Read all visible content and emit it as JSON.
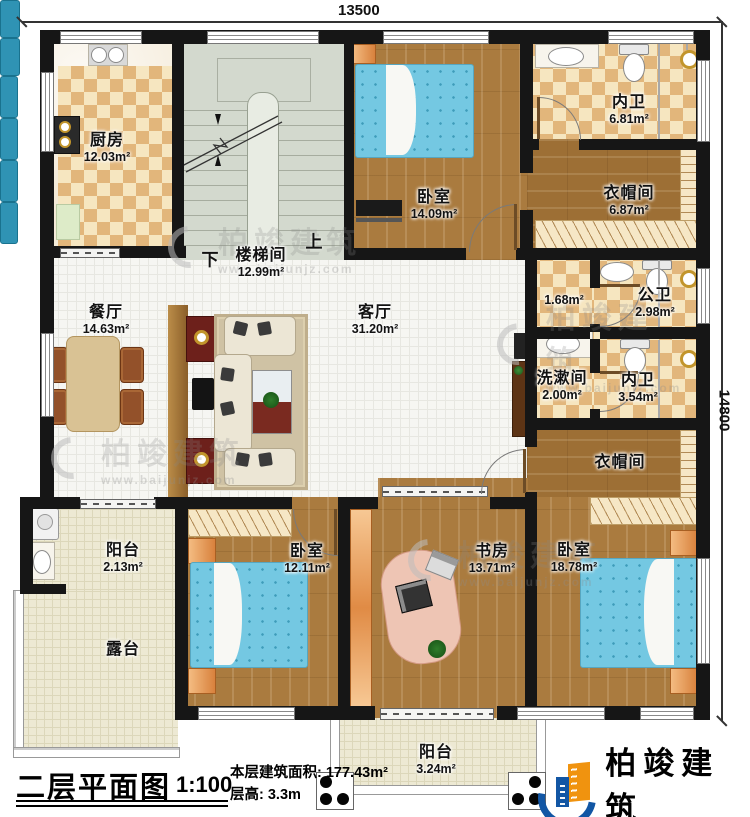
{
  "dimensions": {
    "top": "13500",
    "right": "14800"
  },
  "stair": {
    "down": "下",
    "up": "上"
  },
  "rooms": [
    {
      "key": "kitchen",
      "name": "厨房",
      "area": "12.03m²"
    },
    {
      "key": "stairwell",
      "name": "楼梯间",
      "area": "12.99m²"
    },
    {
      "key": "bedroom-top",
      "name": "卧室",
      "area": "14.09m²"
    },
    {
      "key": "ensuite-top",
      "name": "内卫",
      "area": "6.81m²"
    },
    {
      "key": "closet-top",
      "name": "衣帽间",
      "area": "6.87m²"
    },
    {
      "key": "hallway",
      "name": "",
      "area": "1.68m²"
    },
    {
      "key": "public-bath",
      "name": "公卫",
      "area": "2.98m²"
    },
    {
      "key": "washroom",
      "name": "洗漱间",
      "area": "2.00m²"
    },
    {
      "key": "ensuite-mid",
      "name": "内卫",
      "area": "3.54m²"
    },
    {
      "key": "closet-mid",
      "name": "衣帽间",
      "area": ""
    },
    {
      "key": "dining",
      "name": "餐厅",
      "area": "14.63m²"
    },
    {
      "key": "living",
      "name": "客厅",
      "area": "31.20m²"
    },
    {
      "key": "balcony-left",
      "name": "阳台",
      "area": "2.13m²"
    },
    {
      "key": "terrace",
      "name": "露台",
      "area": ""
    },
    {
      "key": "bedroom-left",
      "name": "卧室",
      "area": "12.11m²"
    },
    {
      "key": "study",
      "name": "书房",
      "area": "13.71m²"
    },
    {
      "key": "bedroom-right",
      "name": "卧室",
      "area": "18.78m²"
    },
    {
      "key": "balcony-bottom",
      "name": "阳台",
      "area": "3.24m²"
    }
  ],
  "title_block": {
    "title": "二层平面图",
    "scale": "1:100",
    "area_line": "本层建筑面积: 177.43m²",
    "height_line": "层高: 3.3m"
  },
  "brand": {
    "name": "柏竣建筑",
    "website": "www.baijunjz.com"
  },
  "watermark": {
    "name": "柏竣建筑",
    "website": "www.baijunjz.com"
  },
  "colors": {
    "wall": "#161616",
    "wood": "#aa7b3f",
    "tile_check": "#e2b67b",
    "bed_blue": "#74c8e2",
    "brand_blue": "#1256a4",
    "brand_orange": "#f0930f"
  }
}
